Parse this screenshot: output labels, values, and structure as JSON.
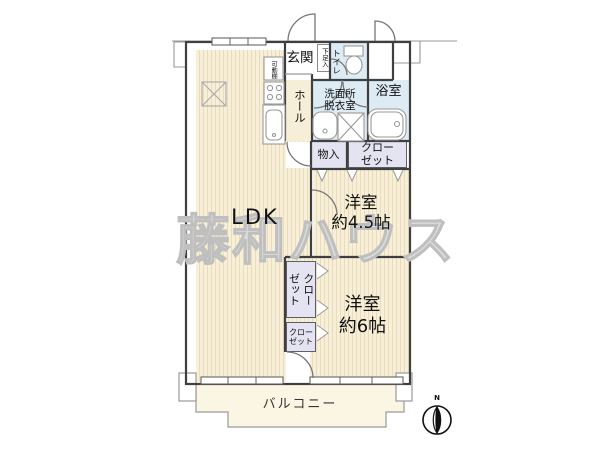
{
  "watermark": {
    "text": "藤和ハウス"
  },
  "compass": {
    "label": "N"
  },
  "rooms": {
    "ldk": {
      "label": "LDK"
    },
    "western_4_5": {
      "line1": "洋室",
      "line2": "約4.5帖"
    },
    "western_6": {
      "line1": "洋室",
      "line2": "約6帖"
    },
    "entrance": {
      "label": "玄関"
    },
    "hall": {
      "label": "ホール"
    },
    "toilet": {
      "label": "トイレ"
    },
    "shoe_cabinet": {
      "label": "下足入"
    },
    "movable_shelf": {
      "label": "可動棚"
    },
    "washroom": {
      "line1": "洗面所",
      "line2": "脱衣室"
    },
    "bathroom": {
      "label": "浴室"
    },
    "storage": {
      "label": "物入"
    },
    "closet_upper": {
      "line1": "クロー",
      "line2": "ゼット"
    },
    "closet_tall": {
      "col_right": "クロー",
      "col_left": "ゼット"
    },
    "closet_lower": {
      "line1": "クロー",
      "line2": "ゼット"
    },
    "balcony": {
      "label": "バルコニー"
    }
  },
  "colors": {
    "floor_cream": "#f8efd8",
    "floor_stripe": "#eadcbb",
    "wet_area_blue": "#ddecf4",
    "closet_lavender": "#e3e3f1",
    "balcony_cream": "#fbf6e4",
    "wall": "#3f3f3f",
    "thin_line": "#999999",
    "watermark_gray": "#bfbfbf"
  }
}
